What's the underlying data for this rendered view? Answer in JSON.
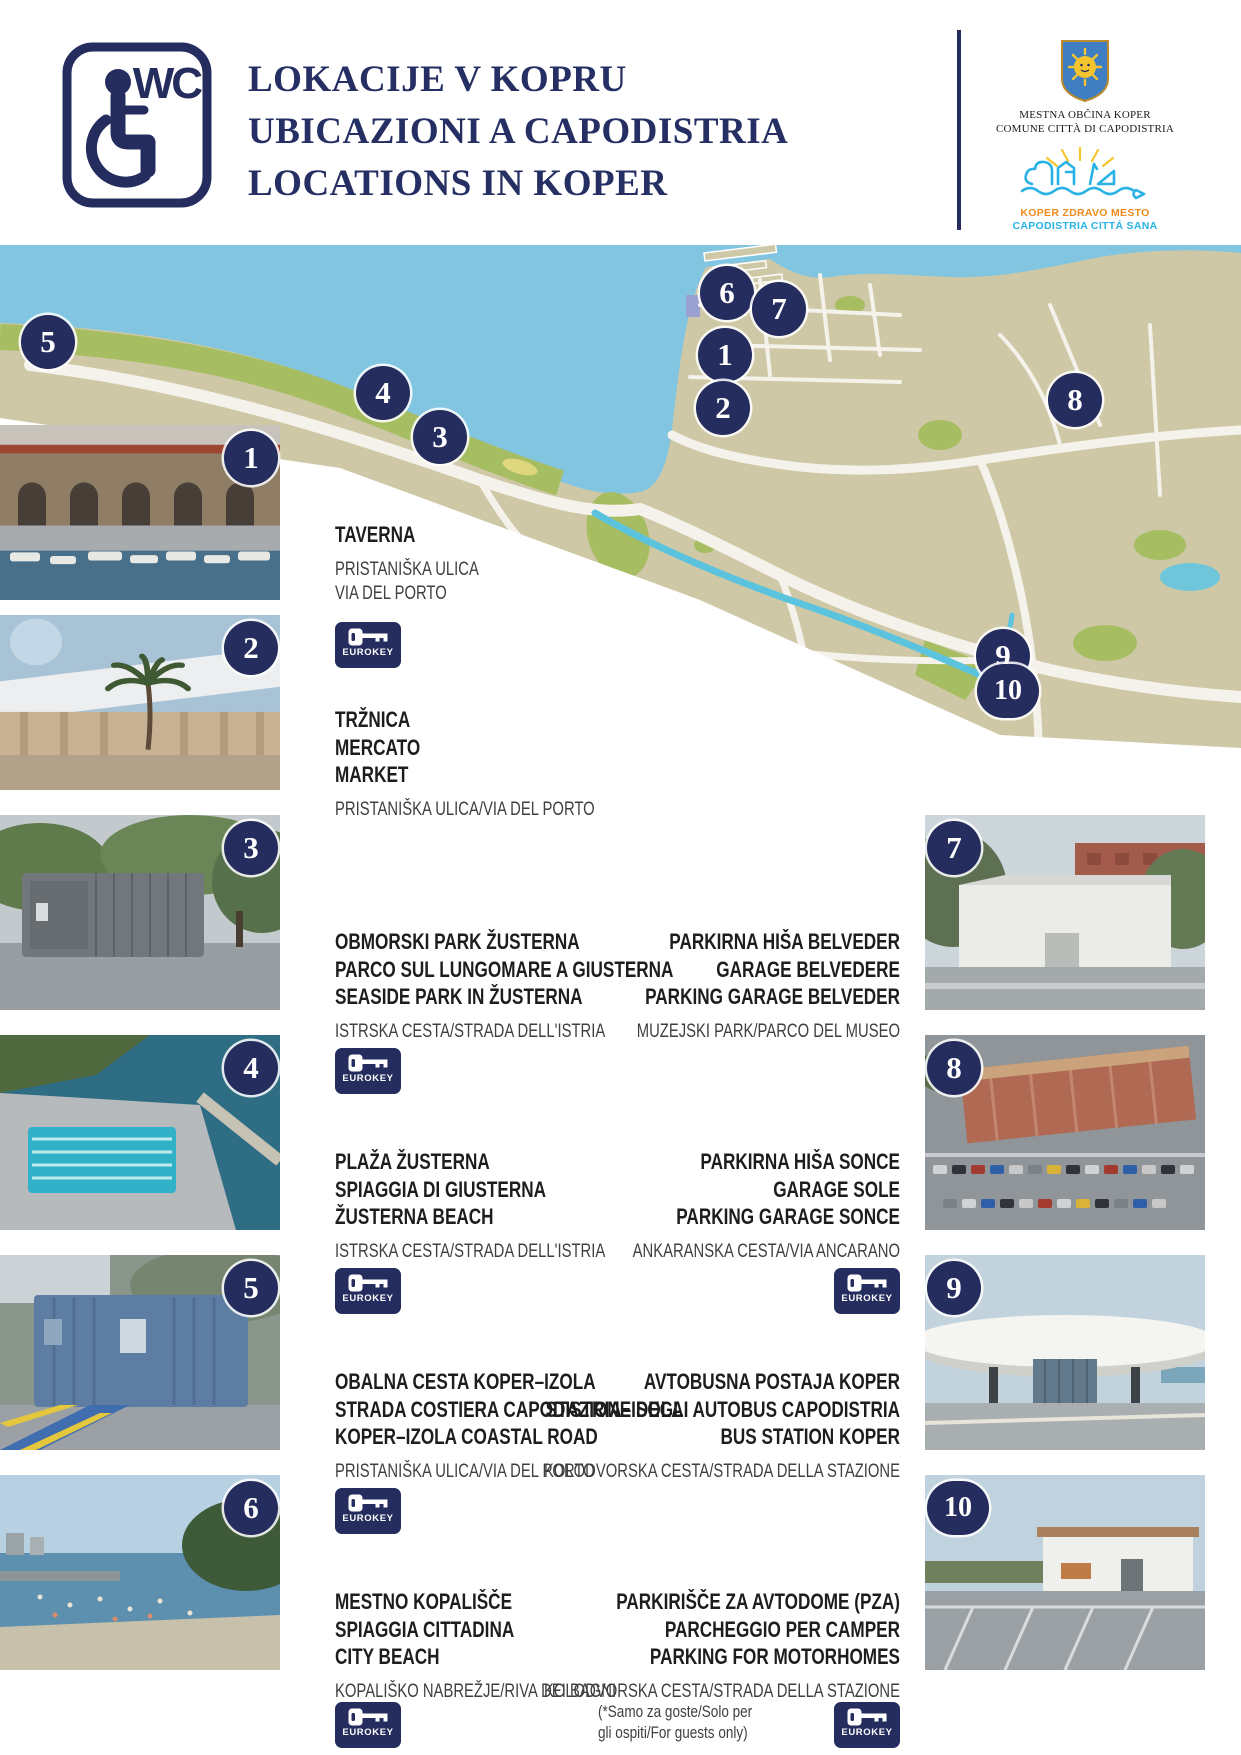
{
  "header": {
    "wc_label": "WC",
    "title_lines": [
      "LOKACIJE V KOPRU",
      "UBICAZIONI A CAPODISTRIA",
      "LOCATIONS IN KOPER"
    ],
    "municipality_logo": {
      "line1": "MESTNA OBČINA KOPER",
      "line2": "COMUNE CITTÀ DI CAPODISTRIA"
    },
    "healthy_city_logo": {
      "line1": "KOPER ZDRAVO MESTO",
      "line2": "CAPODISTRIA CITTÁ SANA"
    }
  },
  "ui": {
    "eurokey_label": "EUROKEY"
  },
  "colors": {
    "navy": "#252c5e",
    "sea": "#82c5e1",
    "land": "#cec8a6",
    "green": "#a7bd62",
    "road": "#f4f2ea",
    "canal": "#5cc3de",
    "healthy_orange": "#ef8a1d",
    "healthy_cyan": "#29b2e5",
    "shield_blue": "#3f7ec1",
    "sun_yellow": "#f5c52e"
  },
  "map": {
    "markers": [
      {
        "n": "1"
      },
      {
        "n": "2"
      },
      {
        "n": "3"
      },
      {
        "n": "4"
      },
      {
        "n": "5"
      },
      {
        "n": "6"
      },
      {
        "n": "7"
      },
      {
        "n": "8"
      },
      {
        "n": "9"
      },
      {
        "n": "10"
      }
    ]
  },
  "locations": [
    {
      "number": "1",
      "names": [
        "TAVERNA"
      ],
      "address_lines": [
        "PRISTANIŠKA ULICA",
        "VIA DEL PORTO"
      ],
      "eurokey": true
    },
    {
      "number": "2",
      "names": [
        "TRŽNICA",
        "MERCATO",
        "MARKET"
      ],
      "address_lines": [
        "PRISTANIŠKA ULICA/VIA DEL PORTO"
      ],
      "eurokey": false
    },
    {
      "number": "3",
      "names": [
        "OBMORSKI PARK ŽUSTERNA",
        "PARCO SUL LUNGOMARE A GIUSTERNA",
        "SEASIDE PARK IN ŽUSTERNA"
      ],
      "address_lines": [
        "ISTRSKA CESTA/STRADA DELL'ISTRIA"
      ],
      "eurokey": true
    },
    {
      "number": "4",
      "names": [
        "PLAŽA ŽUSTERNA",
        "SPIAGGIA DI GIUSTERNA",
        "ŽUSTERNA BEACH"
      ],
      "address_lines": [
        "ISTRSKA CESTA/STRADA DELL'ISTRIA"
      ],
      "eurokey": true
    },
    {
      "number": "5",
      "names": [
        "OBALNA CESTA KOPER–IZOLA",
        "STRADA COSTIERA CAPODISTRIA–ISOLA",
        "KOPER–IZOLA COASTAL ROAD"
      ],
      "address_lines": [
        "PRISTANIŠKA ULICA/VIA DEL PORTO"
      ],
      "eurokey": true
    },
    {
      "number": "6",
      "names": [
        "MESTNO KOPALIŠČE",
        "SPIAGGIA CITTADINA",
        "CITY BEACH"
      ],
      "address_lines": [
        "KOPALIŠKO NABREŽJE/RIVA DEI BAGNI"
      ],
      "eurokey": true
    },
    {
      "number": "7",
      "names": [
        "PARKIRNA HIŠA BELVEDER",
        "GARAGE BELVEDERE",
        "PARKING GARAGE BELVEDER"
      ],
      "address_lines": [
        "MUZEJSKI PARK/PARCO DEL MUSEO"
      ],
      "eurokey": false
    },
    {
      "number": "8",
      "names": [
        "PARKIRNA HIŠA SONCE",
        "GARAGE SOLE",
        "PARKING GARAGE SONCE"
      ],
      "address_lines": [
        "ANKARANSKA CESTA/VIA ANCARANO"
      ],
      "eurokey": true
    },
    {
      "number": "9",
      "names": [
        "AVTOBUSNA POSTAJA KOPER",
        "STAZIONE DEGLI AUTOBUS CAPODISTRIA",
        "BUS STATION KOPER"
      ],
      "address_lines": [
        "KOLODVORSKA CESTA/STRADA DELLA STAZIONE"
      ],
      "eurokey": false
    },
    {
      "number": "10",
      "names": [
        "PARKIRIŠČE ZA AVTODOME (PZA)",
        "PARCHEGGIO PER CAMPER",
        "PARKING FOR MOTORHOMES"
      ],
      "address_lines": [
        "KOLODVORSKA CESTA/STRADA DELLA STAZIONE"
      ],
      "note_lines": [
        "(*Samo za goste/Solo per",
        "gli ospiti/For guests only)"
      ],
      "eurokey": true
    }
  ]
}
